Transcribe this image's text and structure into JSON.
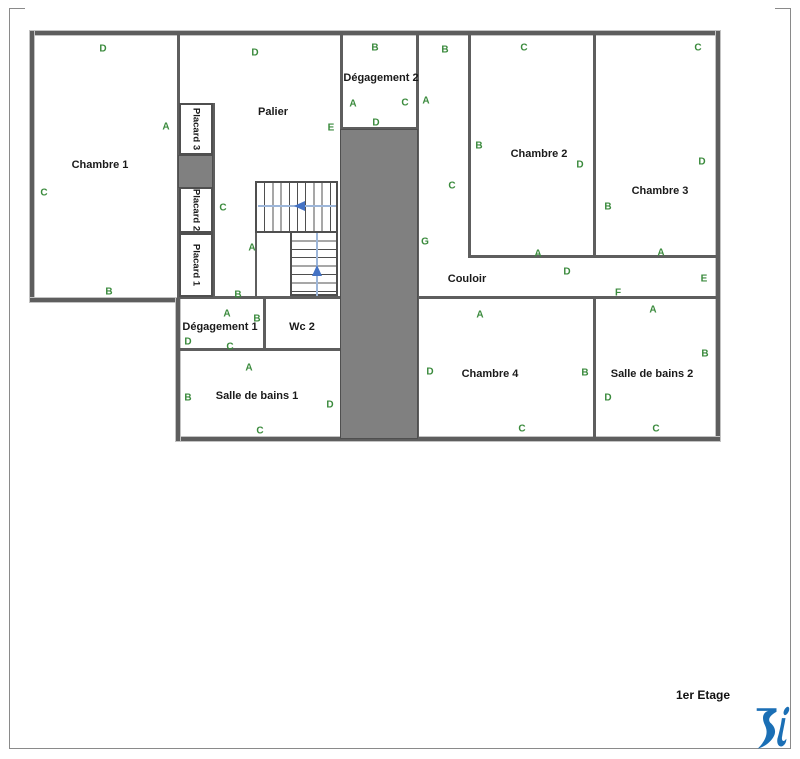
{
  "page": {
    "title": "1er Etage",
    "logo": "blue-ri-logo-icon"
  },
  "colors": {
    "wall": "#5e5e5e",
    "gray_fill": "#808080",
    "door_label_green": "#3a8a3c",
    "stair_arrow_blue": "#4472c4",
    "logo_blue": "#1b6fb5"
  },
  "floorplan": {
    "rooms": [
      {
        "name": "Chambre 1",
        "x": 100,
        "y": 165,
        "vertical": false
      },
      {
        "name": "Palier",
        "x": 273,
        "y": 112,
        "vertical": false
      },
      {
        "name": "Placard 3",
        "x": 196,
        "y": 129,
        "vertical": true
      },
      {
        "name": "Placard 2",
        "x": 196,
        "y": 210,
        "vertical": true
      },
      {
        "name": "Placard 1",
        "x": 196,
        "y": 265,
        "vertical": true
      },
      {
        "name": "Dégagement 2",
        "x": 381,
        "y": 78,
        "vertical": false
      },
      {
        "name": "Chambre 2",
        "x": 539,
        "y": 154,
        "vertical": false
      },
      {
        "name": "Chambre 3",
        "x": 660,
        "y": 191,
        "vertical": false
      },
      {
        "name": "Couloir",
        "x": 467,
        "y": 279,
        "vertical": false
      },
      {
        "name": "Chambre 4",
        "x": 490,
        "y": 374,
        "vertical": false
      },
      {
        "name": "Salle de bains 2",
        "x": 652,
        "y": 374,
        "vertical": false
      },
      {
        "name": "Dégagement 1",
        "x": 220,
        "y": 327,
        "vertical": false
      },
      {
        "name": "Wc 2",
        "x": 302,
        "y": 327,
        "vertical": false
      },
      {
        "name": "Salle de bains 1",
        "x": 257,
        "y": 396,
        "vertical": false
      }
    ],
    "door_labels": [
      {
        "t": "D",
        "x": 103,
        "y": 49
      },
      {
        "t": "A",
        "x": 166,
        "y": 127
      },
      {
        "t": "C",
        "x": 44,
        "y": 193
      },
      {
        "t": "B",
        "x": 109,
        "y": 292
      },
      {
        "t": "D",
        "x": 255,
        "y": 53
      },
      {
        "t": "E",
        "x": 331,
        "y": 128
      },
      {
        "t": "C",
        "x": 223,
        "y": 208
      },
      {
        "t": "A",
        "x": 252,
        "y": 248
      },
      {
        "t": "B",
        "x": 238,
        "y": 295
      },
      {
        "t": "B",
        "x": 375,
        "y": 48
      },
      {
        "t": "A",
        "x": 353,
        "y": 104
      },
      {
        "t": "C",
        "x": 405,
        "y": 103
      },
      {
        "t": "D",
        "x": 376,
        "y": 123
      },
      {
        "t": "B",
        "x": 445,
        "y": 50
      },
      {
        "t": "A",
        "x": 426,
        "y": 101
      },
      {
        "t": "C",
        "x": 452,
        "y": 186
      },
      {
        "t": "G",
        "x": 425,
        "y": 242
      },
      {
        "t": "C",
        "x": 524,
        "y": 48
      },
      {
        "t": "B",
        "x": 479,
        "y": 146
      },
      {
        "t": "D",
        "x": 580,
        "y": 165
      },
      {
        "t": "A",
        "x": 538,
        "y": 254
      },
      {
        "t": "C",
        "x": 698,
        "y": 48
      },
      {
        "t": "D",
        "x": 702,
        "y": 162
      },
      {
        "t": "B",
        "x": 608,
        "y": 207
      },
      {
        "t": "A",
        "x": 661,
        "y": 253
      },
      {
        "t": "D",
        "x": 567,
        "y": 272
      },
      {
        "t": "E",
        "x": 704,
        "y": 279
      },
      {
        "t": "F",
        "x": 618,
        "y": 293
      },
      {
        "t": "A",
        "x": 480,
        "y": 315
      },
      {
        "t": "D",
        "x": 430,
        "y": 372
      },
      {
        "t": "B",
        "x": 585,
        "y": 373
      },
      {
        "t": "C",
        "x": 522,
        "y": 429
      },
      {
        "t": "A",
        "x": 653,
        "y": 310
      },
      {
        "t": "B",
        "x": 705,
        "y": 354
      },
      {
        "t": "D",
        "x": 608,
        "y": 398
      },
      {
        "t": "C",
        "x": 656,
        "y": 429
      },
      {
        "t": "A",
        "x": 227,
        "y": 314
      },
      {
        "t": "B",
        "x": 257,
        "y": 319
      },
      {
        "t": "D",
        "x": 188,
        "y": 342
      },
      {
        "t": "C",
        "x": 230,
        "y": 347
      },
      {
        "t": "A",
        "x": 249,
        "y": 368
      },
      {
        "t": "B",
        "x": 188,
        "y": 398
      },
      {
        "t": "D",
        "x": 330,
        "y": 405
      },
      {
        "t": "C",
        "x": 260,
        "y": 431
      }
    ]
  }
}
